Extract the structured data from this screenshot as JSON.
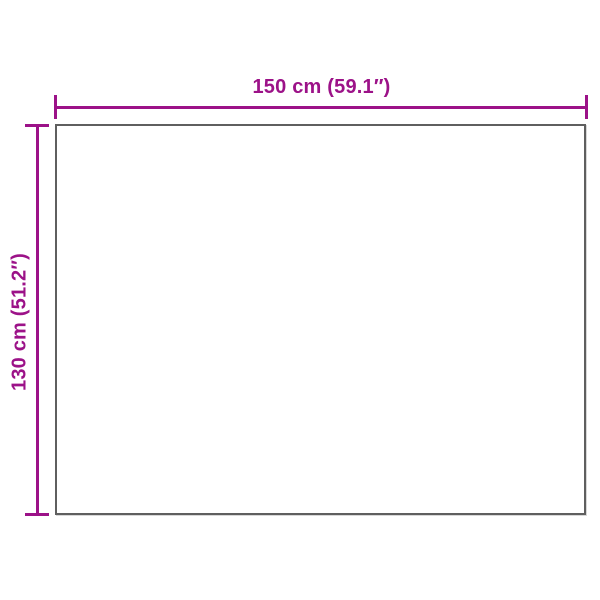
{
  "page": {
    "type": "product-dimension-diagram",
    "background": "#ffffff"
  },
  "colors": {
    "dimension_accent": "#9C1288",
    "outline_gray": "#5F5F5F"
  },
  "diagram": {
    "shape": "rectangle",
    "width_dimension": {
      "label": "150 cm (59.1″)",
      "value_cm": 150,
      "value_inch": 59.1
    },
    "height_dimension": {
      "label": "130 cm (51.2″)",
      "value_cm": 130,
      "value_inch": 51.2
    }
  }
}
